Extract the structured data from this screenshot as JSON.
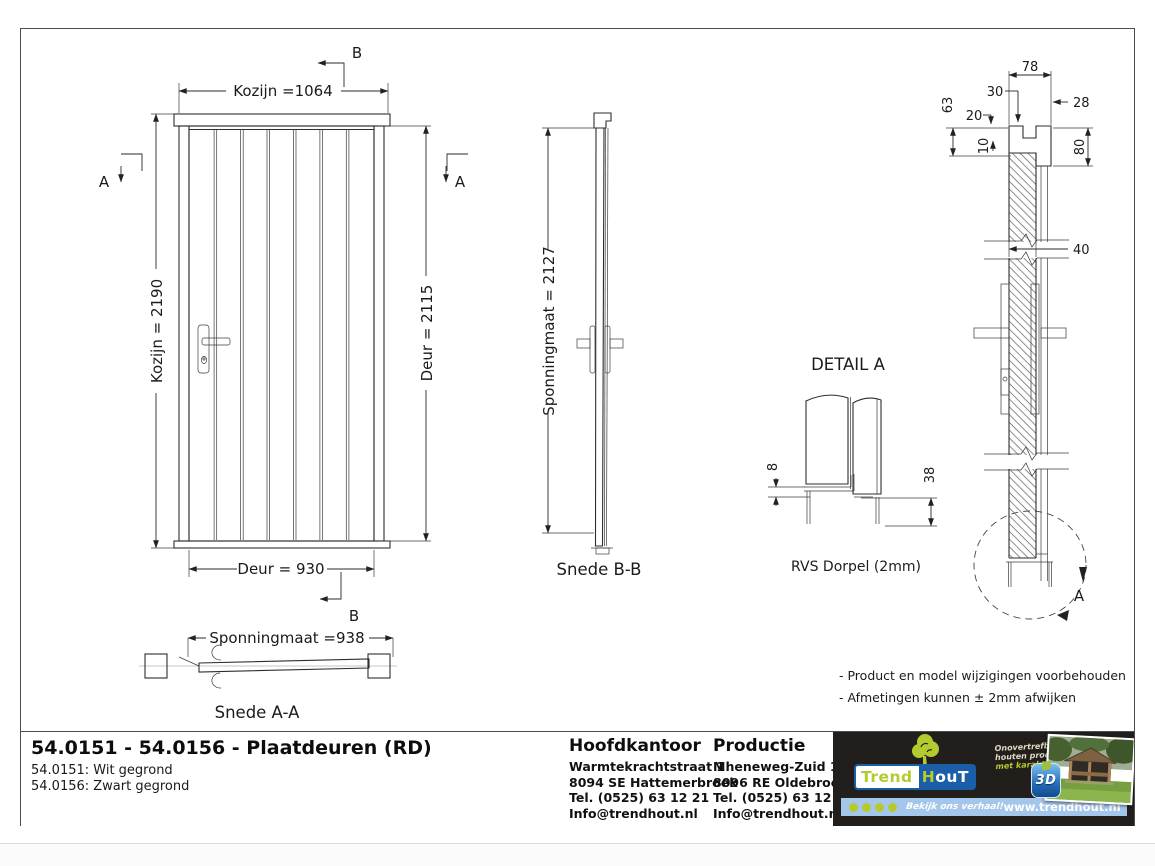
{
  "drawing": {
    "front_view": {
      "dim_width_top": "Kozijn =1064",
      "dim_height_left": "Kozijn = 2190",
      "dim_height_right": "Deur = 2115",
      "dim_width_bottom": "Deur = 930",
      "section_marker_a": "A",
      "section_marker_b": "B"
    },
    "section_aa": {
      "dim": "Sponningmaat =938",
      "label": "Snede A-A"
    },
    "section_bb": {
      "dim": "Sponningmaat = 2127",
      "label": "Snede B-B"
    },
    "detail_a": {
      "title": "DETAIL  A",
      "dim_top": "8",
      "dim_bottom": "38",
      "caption": "RVS Dorpel (2mm)"
    },
    "vertical_section": {
      "dim_78": "78",
      "dim_30": "30",
      "dim_28": "28",
      "dim_63": "63",
      "dim_20": "20",
      "dim_10": "10",
      "dim_80": "80",
      "dim_40": "40",
      "detail_marker": "A"
    },
    "notes": [
      "- Product en model wijzigingen voorbehouden",
      "- Afmetingen kunnen ± 2mm afwijken"
    ]
  },
  "title_block": {
    "title": "54.0151 - 54.0156 - Plaatdeuren (RD)",
    "variant1": "54.0151: Wit gegrond",
    "variant2": "54.0156: Zwart gegrond",
    "hoofdkantoor": {
      "heading": "Hoofdkantoor",
      "address1": "Warmtekrachtstraat 1",
      "address2": "8094 SE Hattemerbroek",
      "tel": "Tel. (0525) 63 12 21",
      "email": "Info@trendhout.nl"
    },
    "productie": {
      "heading": "Productie",
      "address1": "Mheneweg-Zuid 1b",
      "address2": "8096 RE Oldebroek",
      "tel": "Tel. (0525) 63 12 21",
      "email": "Info@trendhout.nl"
    }
  },
  "footer_brand": {
    "brand_part1": "Trend",
    "brand_part2_h": "H",
    "brand_part2_rest": "ouT",
    "tagline": [
      "Onovertrefbare",
      "houten producten",
      "met karakter"
    ],
    "badge_3d": "3D",
    "strip_slogan": "Bekijk ons verhaal!",
    "website": "www.trendhout.nl",
    "colors": {
      "dark": "#211e1c",
      "lime": "#b5ca2f",
      "blue": "#1a5da8",
      "strip": "#a4c6ea"
    }
  }
}
